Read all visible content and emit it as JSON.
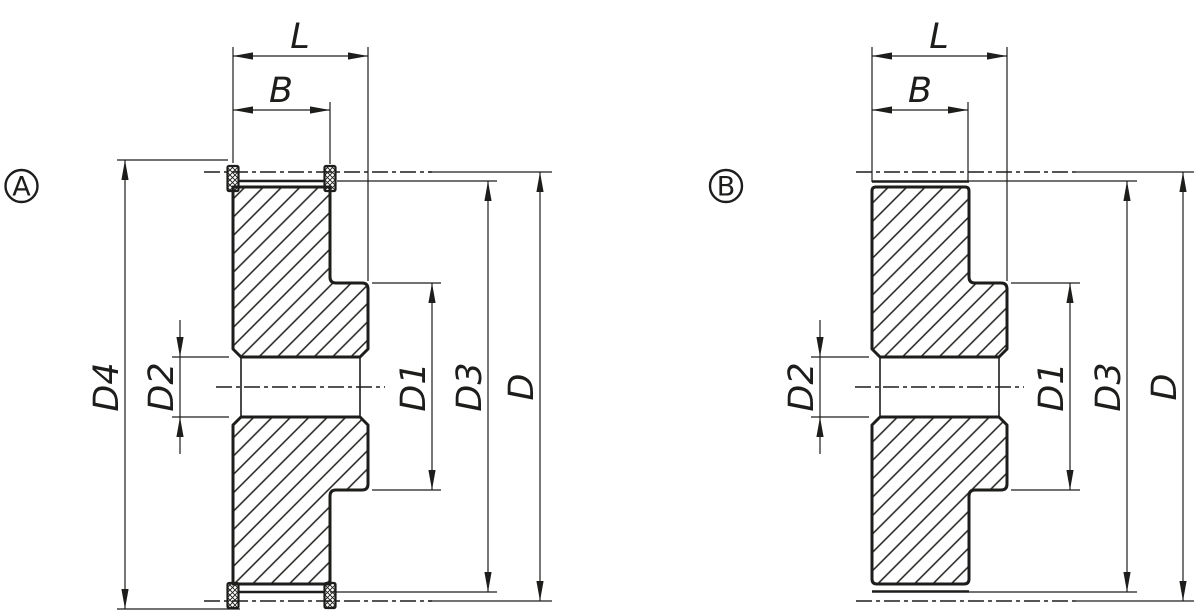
{
  "colors": {
    "ink": "#1d1d1b",
    "paper": "#ffffff"
  },
  "views": {
    "a": {
      "badge": "A",
      "dims": {
        "l": "L",
        "b": "B",
        "d4": "D4",
        "d2": "D2",
        "d1": "D1",
        "d3": "D3",
        "d": "D"
      }
    },
    "b": {
      "badge": "B",
      "dims": {
        "l": "L",
        "b": "B",
        "d2": "D2",
        "d1": "D1",
        "d3": "D3",
        "d": "D"
      }
    }
  }
}
